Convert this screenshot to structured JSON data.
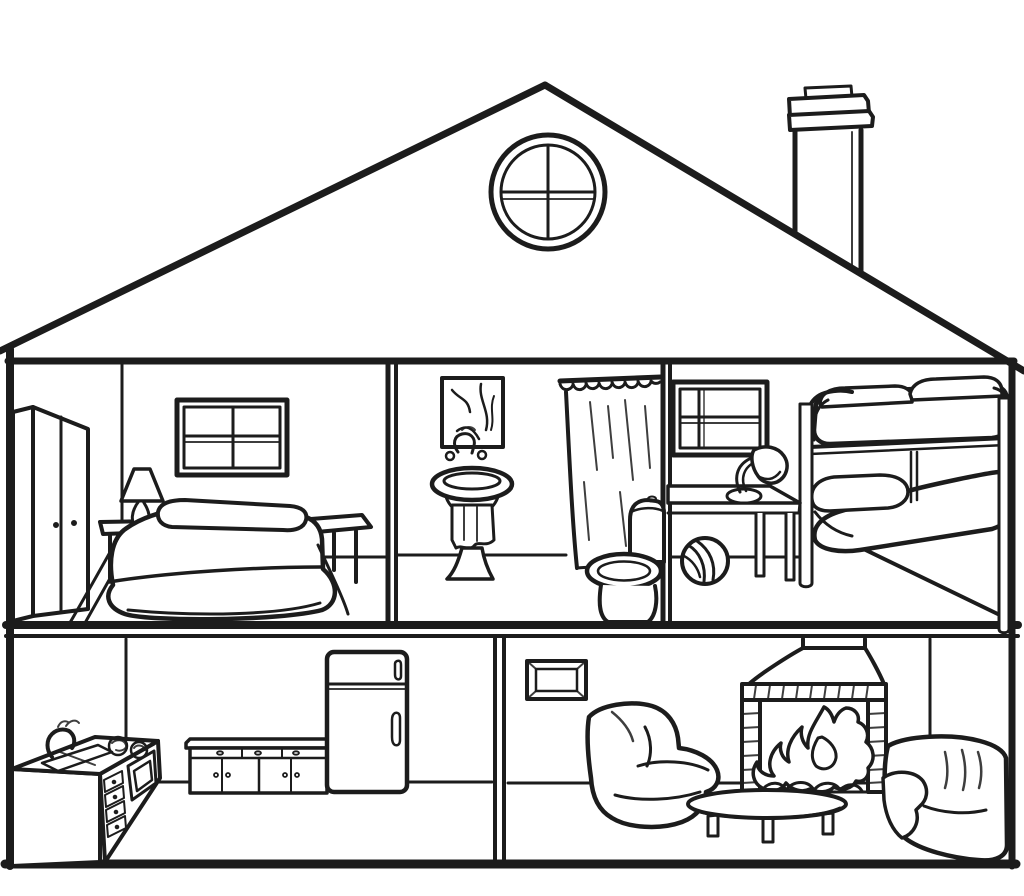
{
  "scene": {
    "title": "House cross-section coloring page",
    "style": "black-and-white line drawing, cutaway dollhouse view",
    "floor_count": 2,
    "room_count": 5
  },
  "colors": {
    "background": "#ffffff",
    "line": "#1c1c1c"
  },
  "house": {
    "roof": "pitched roof",
    "gable_window": "round gable window with cross muntins",
    "chimney": "chimney with cap",
    "left_wall": "left exterior wall",
    "right_wall": "right exterior wall",
    "floor_slab": "slab between upper and ground floor",
    "ground": "house base line"
  },
  "floors": [
    {
      "name": "upper floor",
      "rooms": [
        {
          "name": "bedroom",
          "furniture": [
            "wardrobe",
            "window",
            "nightstand",
            "table lamp",
            "double bed with pillow",
            "bench"
          ]
        },
        {
          "name": "bathroom",
          "furniture": [
            "wall picture",
            "pedestal sink with towel and faucet",
            "shower curtain with rings",
            "toilet"
          ]
        },
        {
          "name": "kids bedroom",
          "furniture": [
            "window",
            "bunk bed",
            "desk",
            "desk lamp",
            "ball"
          ]
        }
      ]
    },
    {
      "name": "ground floor",
      "rooms": [
        {
          "name": "kitchen",
          "furniture": [
            "counter with sink, faucet and stove top",
            "oven with drawers",
            "kitchen cabinet",
            "refrigerator"
          ]
        },
        {
          "name": "living room",
          "furniture": [
            "wall picture",
            "armchair",
            "fireplace with fire",
            "coffee table",
            "sofa chair"
          ]
        }
      ]
    }
  ]
}
